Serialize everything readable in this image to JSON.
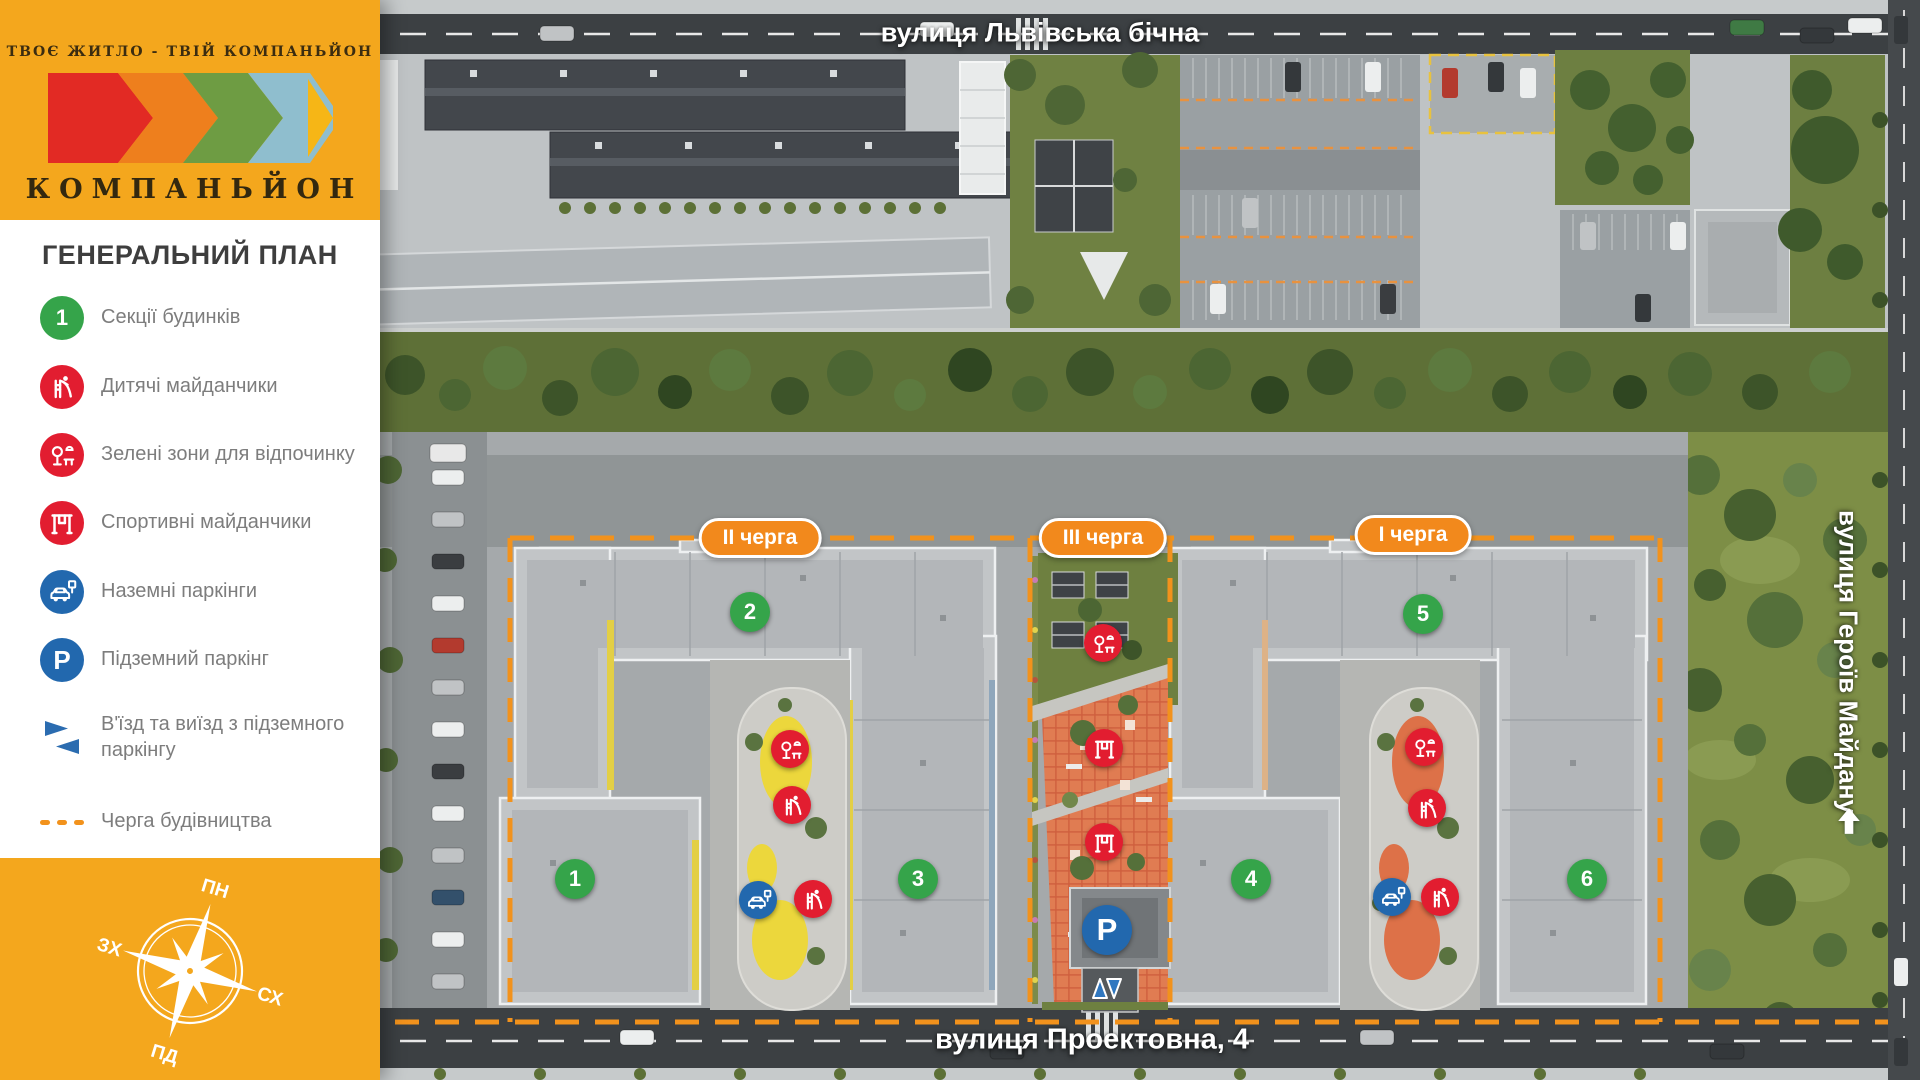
{
  "brand": {
    "tagline": "ТВОЄ ЖИТЛО - ТВІЙ КОМПАНЬЙОН",
    "name": "КОМПАНЬЙОН"
  },
  "sidebar": {
    "title": "ГЕНЕРАЛЬНИЙ ПЛАН",
    "legend": [
      {
        "label": "Секції будинків",
        "badge": "1"
      },
      {
        "label": "Дитячі майданчики"
      },
      {
        "label": "Зелені зони для відпочинку"
      },
      {
        "label": "Спортивні майданчики"
      },
      {
        "label": "Наземні паркінги"
      },
      {
        "label": "Підземний паркінг",
        "glyph": "P"
      },
      {
        "label": "В'їзд та виїзд з підземного паркінгу"
      },
      {
        "label": "Черга будівництва"
      }
    ],
    "compass": {
      "north": "ПН",
      "east": "СХ",
      "south": "ПД",
      "west": "ЗХ"
    }
  },
  "map": {
    "streets": {
      "top": "вулиця Львівська бічна",
      "bottom": "вулиця Проектовна, 4",
      "right": "вулиця Героїв Майдану"
    },
    "phase_badges": [
      "II черга",
      "III черга",
      "I черга"
    ],
    "building_markers": [
      "1",
      "2",
      "3",
      "4",
      "5",
      "6"
    ],
    "underground_parking_glyph": "P"
  },
  "colors": {
    "accent_orange": "#F4A71D",
    "badge_orange": "#F2891C",
    "marker_green": "#35A44A",
    "icon_red": "#E21D30",
    "icon_blue": "#2268AE"
  }
}
